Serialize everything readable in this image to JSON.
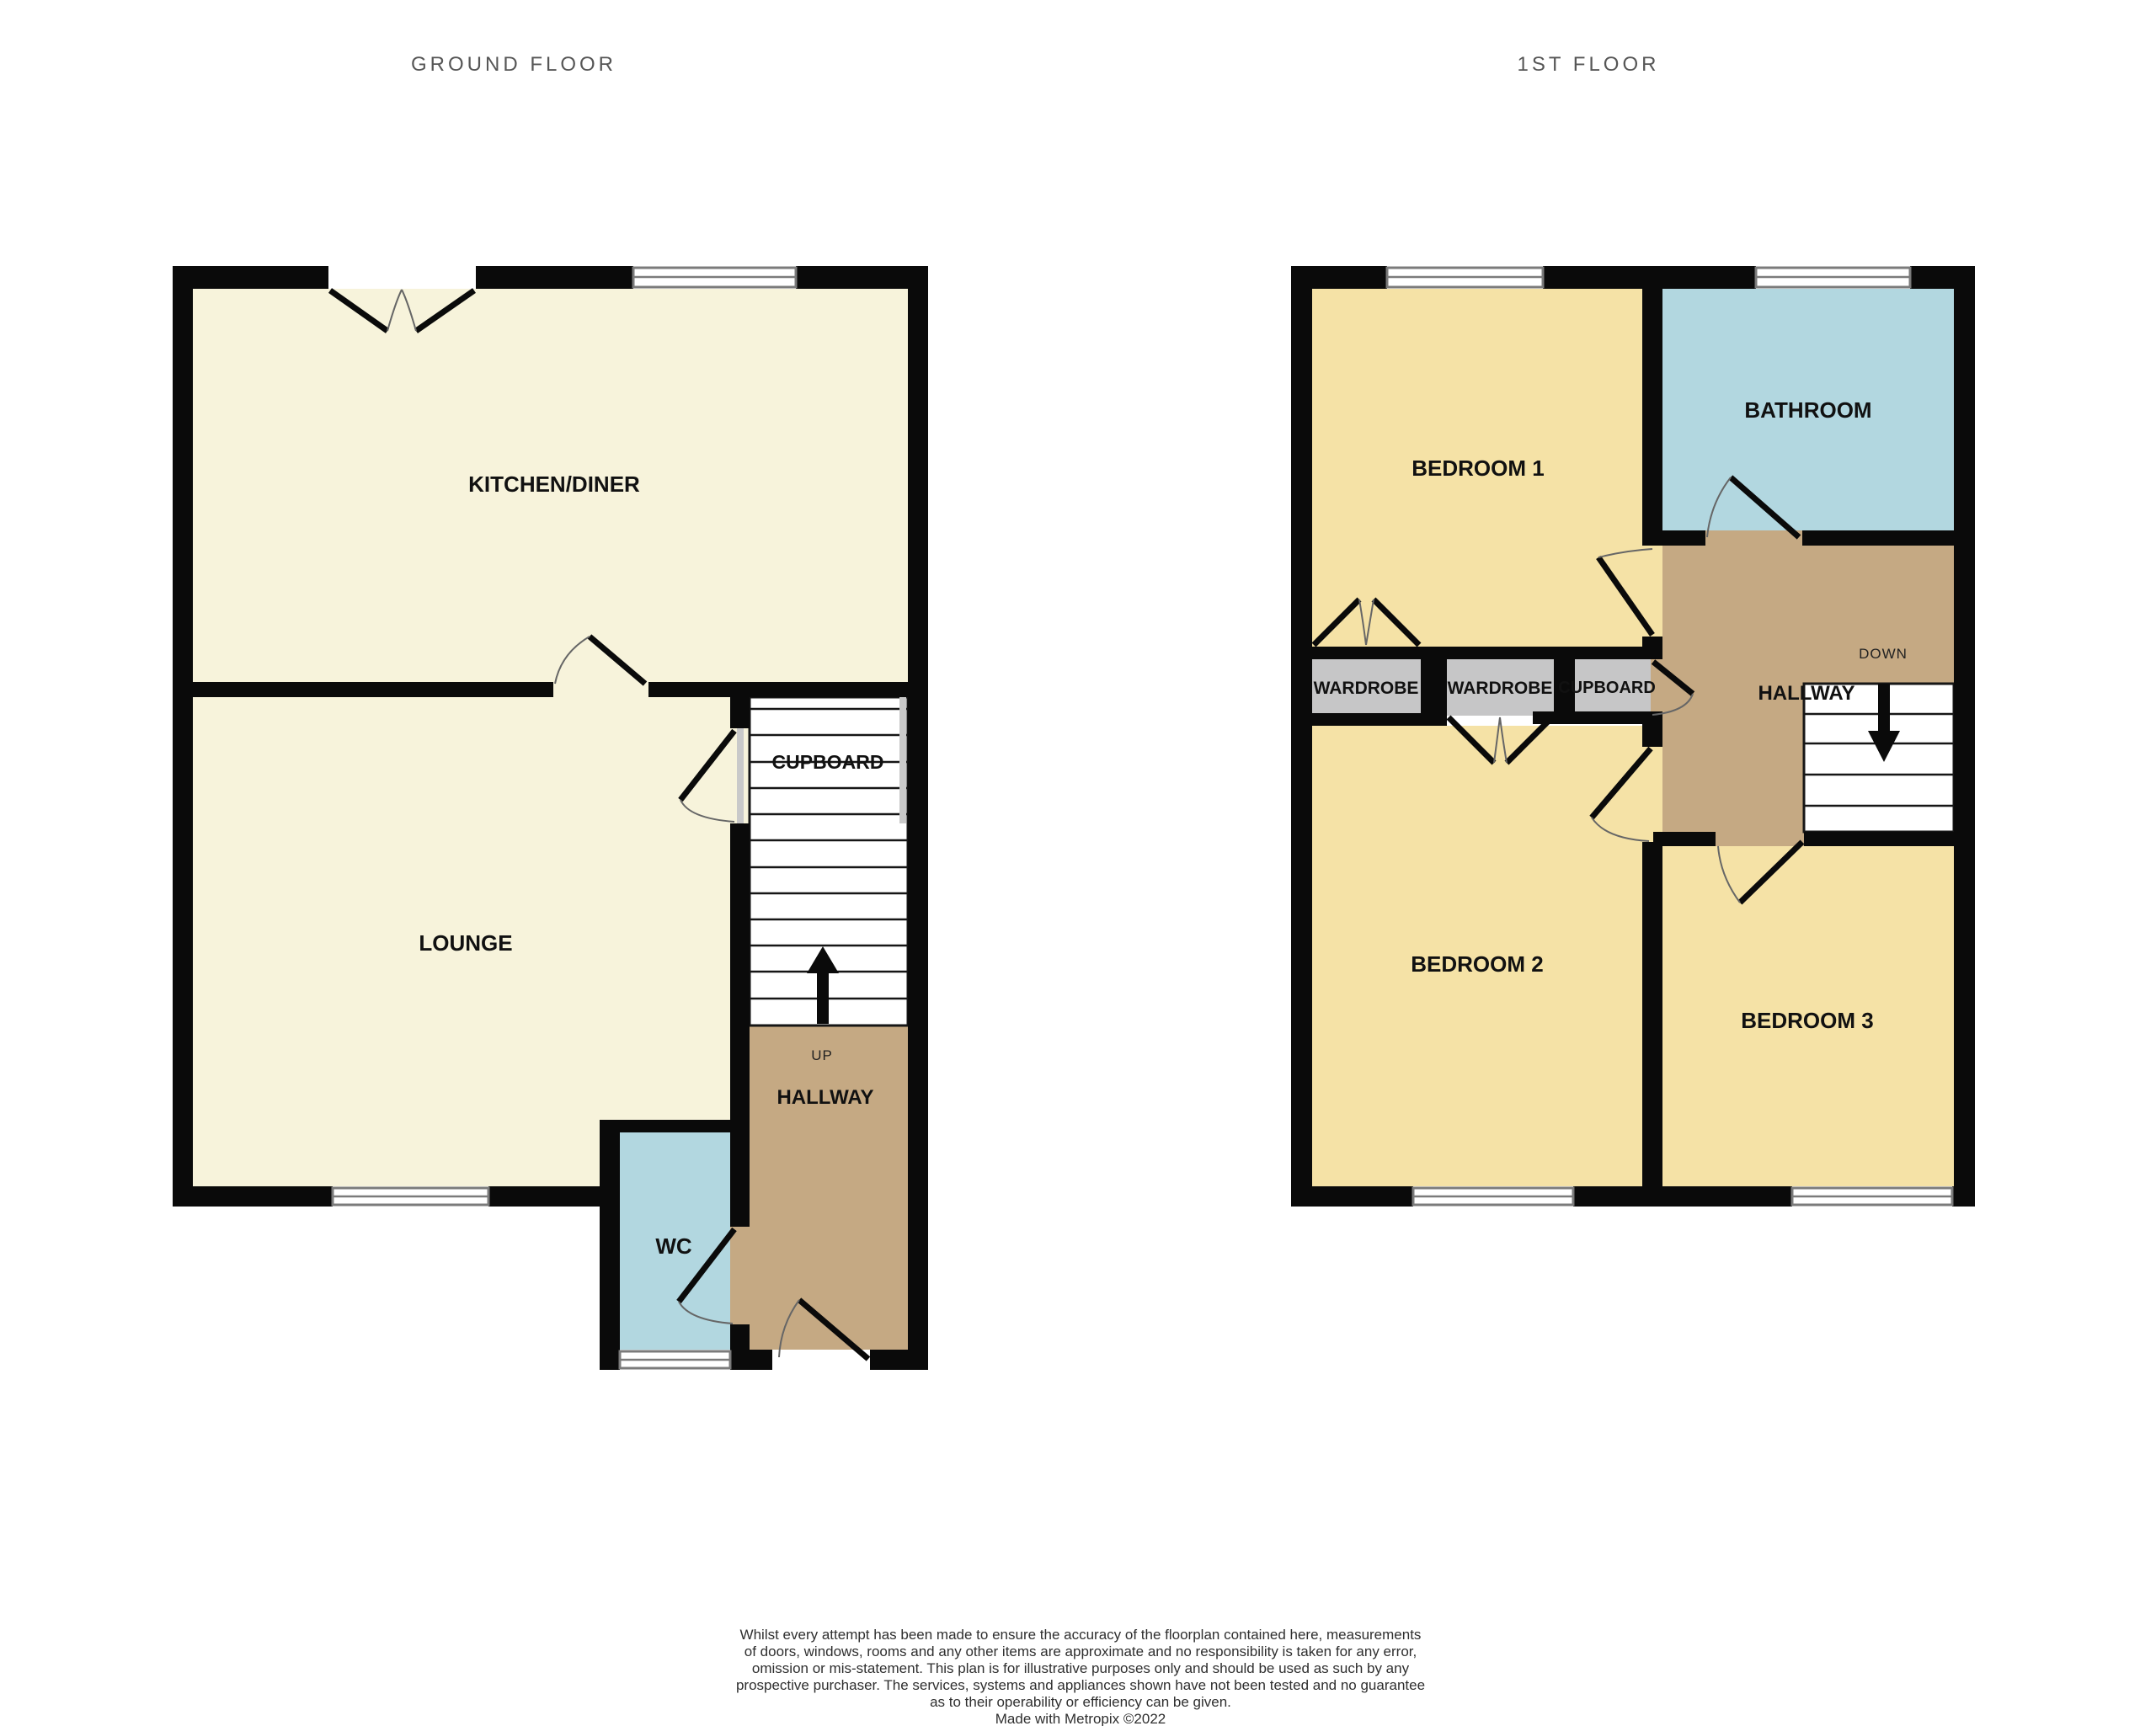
{
  "colors": {
    "wall": "#0a0a0a",
    "cream": "#f7f3db",
    "yellow": "#f5e2a6",
    "blue": "#b2d7e0",
    "tan": "#c5a983",
    "gray": "#c6c6c7",
    "window_line": "#7b7b7b",
    "arc": "#666666",
    "title_gray": "#565656",
    "text_black": "#111111",
    "footer_gray": "#2f2f2f"
  },
  "ground_floor": {
    "title": "GROUND FLOOR",
    "rooms": {
      "kitchen": "KITCHEN/DINER",
      "lounge": "LOUNGE",
      "cupboard": "CUPBOARD",
      "hallway": "HALLWAY",
      "wc": "WC"
    },
    "stairs_label": "UP"
  },
  "first_floor": {
    "title": "1ST FLOOR",
    "rooms": {
      "bedroom1": "BEDROOM 1",
      "bathroom": "BATHROOM",
      "wardrobe1": "WARDROBE",
      "wardrobe2": "WARDROBE",
      "cupboard": "CUPBOARD",
      "hallway": "HALLWAY",
      "bedroom2": "BEDROOM 2",
      "bedroom3": "BEDROOM 3"
    },
    "stairs_label": "DOWN"
  },
  "footer": {
    "lines": [
      "Whilst every attempt has been made to ensure the accuracy of the floorplan contained here, measurements",
      "of doors, windows, rooms and any other items are approximate and no responsibility is taken for any error,",
      "omission or mis-statement. This plan is for illustrative purposes only and should be used as such by any",
      "prospective purchaser. The services, systems and appliances shown have not been tested and no guarantee",
      "as to their operability or efficiency can be given.",
      "Made with Metropix ©2022"
    ]
  }
}
